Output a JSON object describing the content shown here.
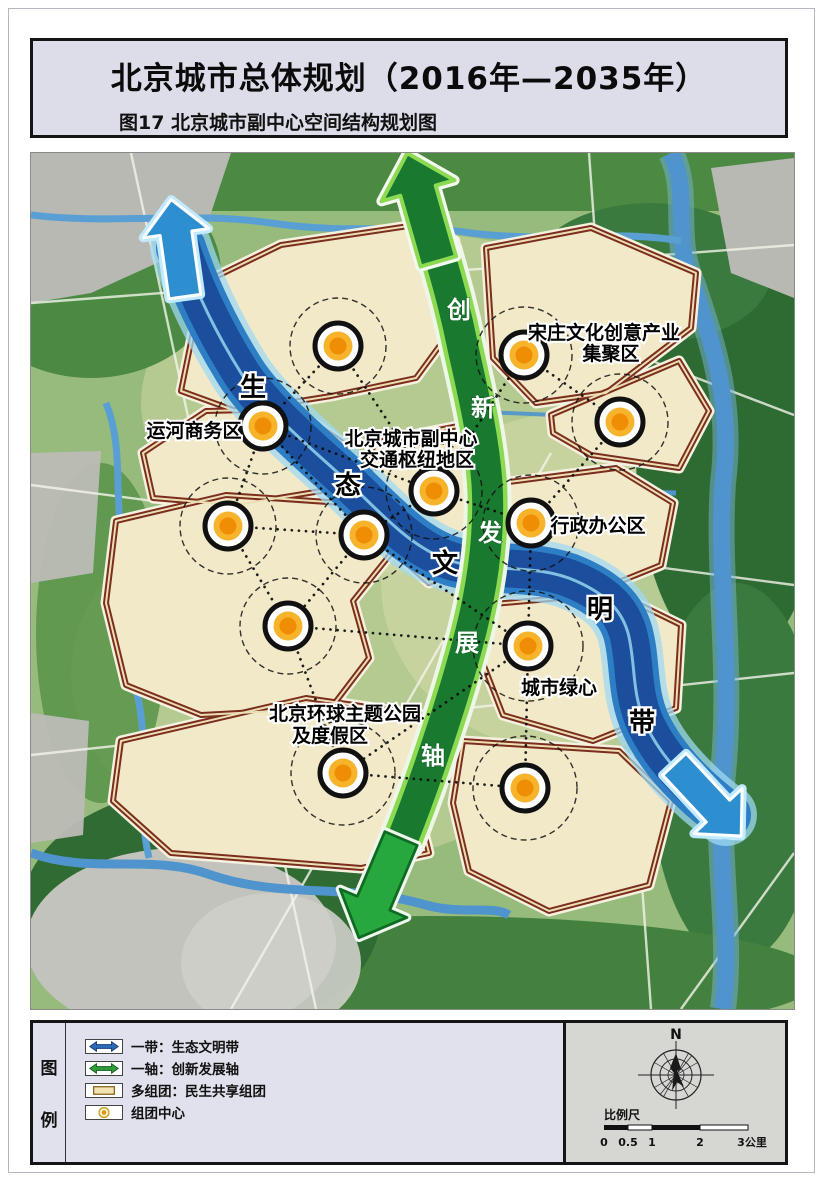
{
  "header": {
    "title": "北京城市总体规划（2016年—2035年）",
    "subtitle": "图17  北京城市副中心空间结构规划图"
  },
  "map": {
    "belt_chars": [
      "生",
      "态",
      "文",
      "明",
      "带"
    ],
    "axis_chars": [
      "创",
      "新",
      "发",
      "展",
      "轴"
    ],
    "labels": {
      "songzhuang": {
        "line1": "宋庄文化创意产业",
        "line2": "集聚区"
      },
      "yunhe": {
        "text": "运河商务区"
      },
      "hub": {
        "line1": "北京城市副中心",
        "line2": "交通枢纽地区"
      },
      "admin": {
        "text": "行政办公区"
      },
      "green_heart": {
        "text": "城市绿心"
      },
      "universal": {
        "line1": "北京环球主题公园",
        "line2": "及度假区"
      }
    }
  },
  "legend": {
    "title_chars": [
      "图",
      "例"
    ],
    "items": [
      {
        "symbol": "belt-arrow",
        "label": "一带：生态文明带"
      },
      {
        "symbol": "axis-arrow",
        "label": "一轴：创新发展轴"
      },
      {
        "symbol": "cluster-rect",
        "label": "多组团：民生共享组团"
      },
      {
        "symbol": "center-circle",
        "label": "组团中心"
      }
    ],
    "compass_north": "N",
    "scale_label": "比例尺",
    "scale_ticks": [
      "0",
      "0.5",
      "1",
      "2",
      "3公里"
    ]
  },
  "colors": {
    "belt_blue": "#1b4e9c",
    "axis_green": "#18792f",
    "bottom_arrow_green": "#27a83e",
    "cluster_fill": "#f2e9c9",
    "cluster_border": "#7c2e1e",
    "center_orange": "#f5a41d"
  }
}
